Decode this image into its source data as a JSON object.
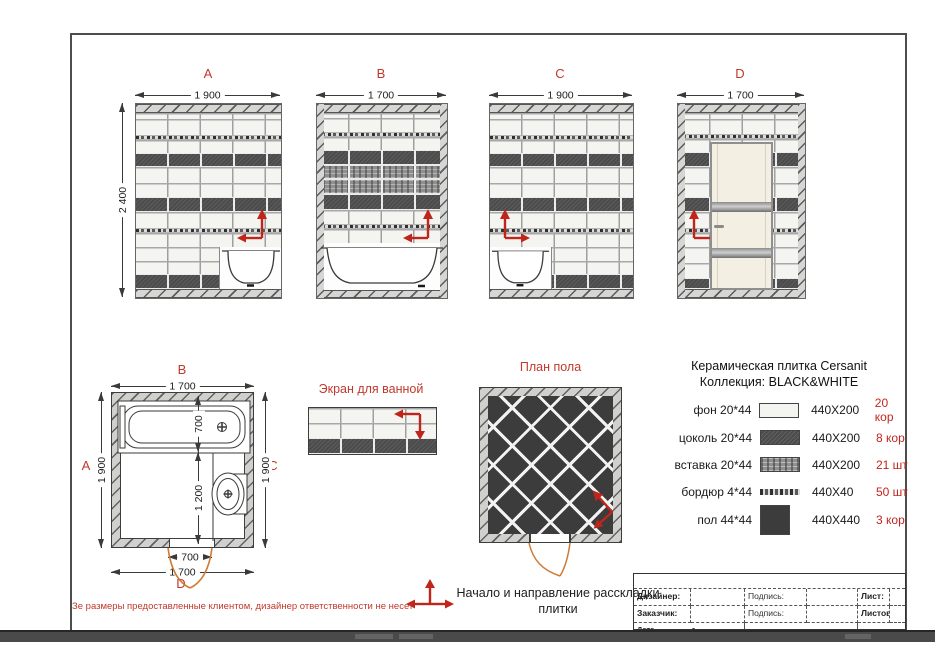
{
  "elevations": [
    {
      "id": "A",
      "label": "A",
      "width_label": "1 900",
      "height_label": "2 400"
    },
    {
      "id": "B",
      "label": "B",
      "width_label": "1 700"
    },
    {
      "id": "C",
      "label": "C",
      "width_label": "1 900"
    },
    {
      "id": "D",
      "label": "D",
      "width_label": "1 700"
    }
  ],
  "tiles": {
    "A": [
      [
        "h",
        9
      ],
      [
        "w",
        6
      ],
      [
        "w",
        16
      ],
      [
        "b",
        5
      ],
      [
        "w",
        13
      ],
      [
        "d",
        14
      ],
      [
        "w",
        16
      ],
      [
        "w",
        14
      ],
      [
        "d",
        15
      ],
      [
        "w",
        16
      ],
      [
        "b",
        5
      ],
      [
        "w",
        14
      ],
      [
        "w",
        14
      ],
      [
        "w",
        13
      ],
      [
        "d",
        15
      ],
      [
        "h",
        9
      ]
    ],
    "B": [
      [
        "h",
        9
      ],
      [
        "w",
        5
      ],
      [
        "w",
        14
      ],
      [
        "b",
        5
      ],
      [
        "w",
        13
      ],
      [
        "d",
        15
      ],
      [
        "i",
        14
      ],
      [
        "i",
        15
      ],
      [
        "d",
        16
      ],
      [
        "w",
        14
      ],
      [
        "b",
        5
      ],
      [
        "w",
        14
      ],
      [
        "bath",
        47
      ],
      [
        "h",
        8
      ]
    ],
    "C": [
      [
        "h",
        9
      ],
      [
        "w",
        6
      ],
      [
        "w",
        16
      ],
      [
        "b",
        5
      ],
      [
        "w",
        13
      ],
      [
        "d",
        14
      ],
      [
        "w",
        16
      ],
      [
        "w",
        14
      ],
      [
        "d",
        15
      ],
      [
        "w",
        16
      ],
      [
        "b",
        5
      ],
      [
        "w",
        14
      ],
      [
        "w",
        14
      ],
      [
        "w",
        13
      ],
      [
        "d",
        15
      ],
      [
        "h",
        9
      ]
    ],
    "D": [
      [
        "h",
        9
      ],
      [
        "w",
        6
      ],
      [
        "w",
        15
      ],
      [
        "b",
        5
      ],
      [
        "w",
        13
      ],
      [
        "d",
        15
      ],
      [
        "w",
        16
      ],
      [
        "w",
        14
      ],
      [
        "d",
        15
      ],
      [
        "w",
        16
      ],
      [
        "b",
        5
      ],
      [
        "w",
        14
      ],
      [
        "w",
        16
      ],
      [
        "w",
        15
      ],
      [
        "d",
        11
      ],
      [
        "h",
        9
      ]
    ],
    "screen": [
      [
        "w",
        15
      ],
      [
        "w",
        15
      ],
      [
        "d",
        16
      ]
    ]
  },
  "floor_plan": {
    "labels": {
      "top": "B",
      "left": "A",
      "right": "C",
      "bottom": "D"
    },
    "dims": {
      "top": "1 700",
      "left": "1 900",
      "right": "1 900",
      "bath_depth": "700",
      "below_bath": "1 200",
      "door": "700",
      "bottom": "1 700"
    }
  },
  "bath_screen": {
    "title": "Экран для ванной"
  },
  "floor_tiling": {
    "title": "План пола"
  },
  "legend": {
    "title_line1": "Керамическая плитка Cersanit",
    "title_line2": "Коллекция: BLACK&WHITE",
    "items": [
      {
        "name": "фон 20*44",
        "size": "440X200",
        "qty": "20 кор",
        "swatch": "white"
      },
      {
        "name": "цоколь 20*44",
        "size": "440X200",
        "qty": "8 кор",
        "swatch": "dark"
      },
      {
        "name": "вставка 20*44",
        "size": "440X200",
        "qty": "21 шт",
        "swatch": "insert"
      },
      {
        "name": "бордюр 4*44",
        "size": "440X40",
        "qty": "50 шт",
        "swatch": "border"
      },
      {
        "name": "пол 44*44",
        "size": "440X440",
        "qty": "3 кор",
        "swatch": "floor"
      }
    ]
  },
  "note": {
    "line1": "Начало и направление расскладки",
    "line2": "плитки"
  },
  "disclaimer": "Зе размеры предоставленные клиентом, дизайнер ответственности не несет",
  "title_block": {
    "designer_label": "Дизайнер:",
    "client_label": "Заказчик:",
    "signature_label": "Подпись:",
    "signature2_label": "Подпись:",
    "sheet_label": "Лист:",
    "sheets_label": "Листов:",
    "date_label": "Дата ________ г."
  },
  "colors": {
    "accent_red": "#c0392b",
    "arc_orange": "#cf7a35",
    "tile_dark": "#4b4b4b",
    "tile_white": "#f4f4f1"
  }
}
